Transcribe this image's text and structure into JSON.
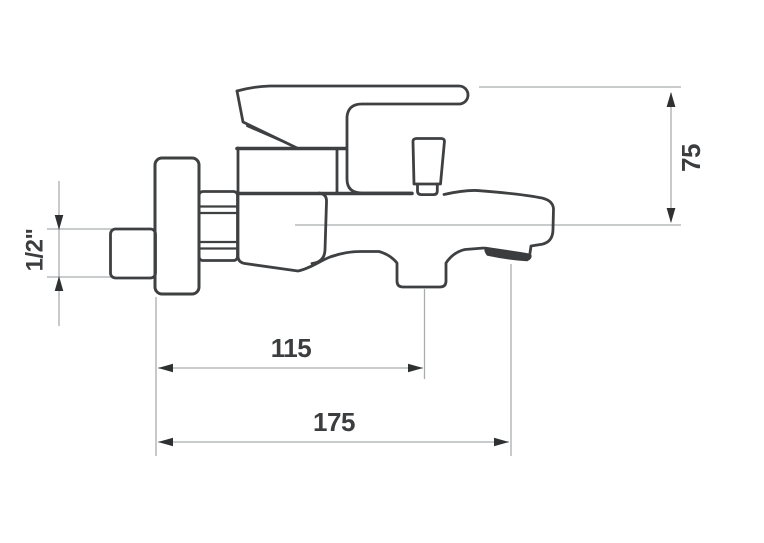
{
  "diagram": {
    "title": "bath-mixer-tap-dimension-drawing",
    "subject": "Wall-mounted single-lever bath mixer tap, side elevation with installation dimensions",
    "background_color": "#ffffff",
    "outline_color": "#3e4042",
    "dimension_line_color": "#a8adaf",
    "arrow_color": "#2e3032",
    "label_color": "#3b3d3f",
    "dimensions": [
      {
        "id": "inlet-thread-size",
        "label": "1/2\"",
        "orientation": "vertical",
        "location": "left"
      },
      {
        "id": "height",
        "label": "75",
        "orientation": "vertical",
        "location": "right"
      },
      {
        "id": "reach-to-diverter",
        "label": "115",
        "orientation": "horizontal",
        "location": "bottom"
      },
      {
        "id": "total-reach",
        "label": "175",
        "orientation": "horizontal",
        "location": "bottom"
      }
    ],
    "parts": [
      "inlet-pipe",
      "wall-flange",
      "hex-nut",
      "valve-body",
      "lever-handle",
      "cartridge-housing",
      "diverter-knob",
      "spout",
      "aerator",
      "pull-knob"
    ]
  }
}
